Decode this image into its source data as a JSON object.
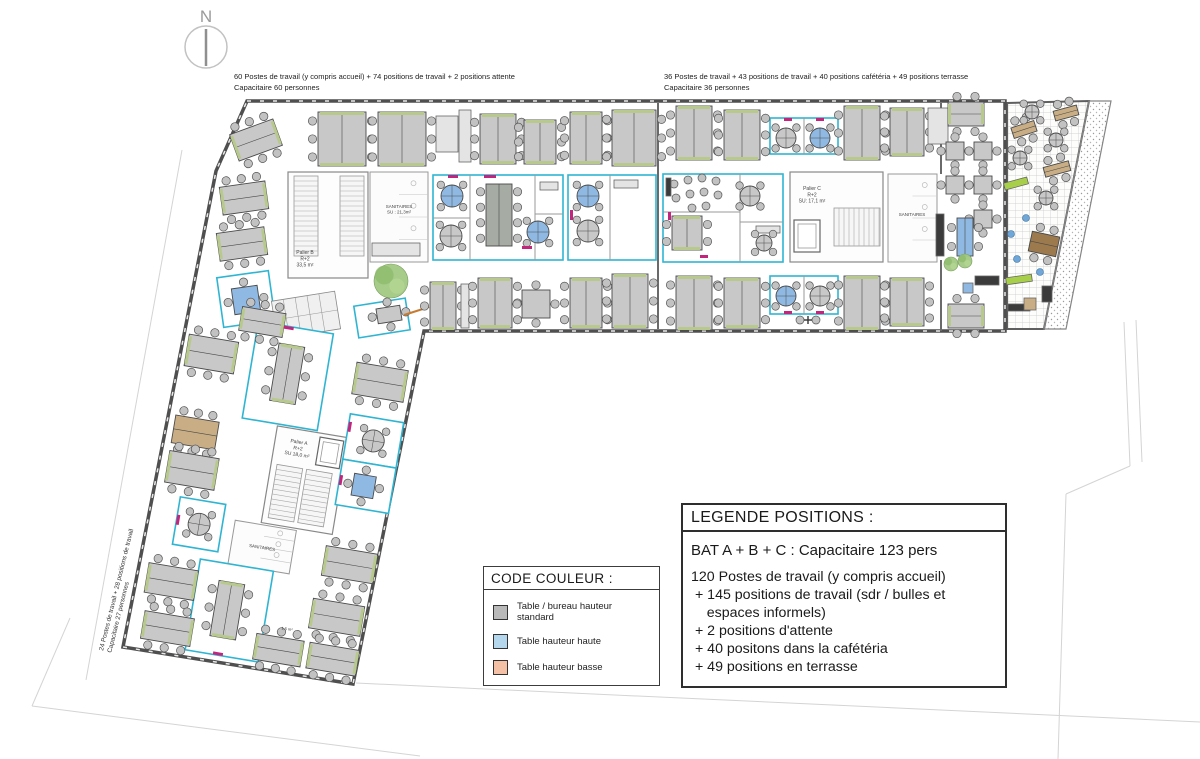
{
  "north": {
    "label": "N"
  },
  "annotations": {
    "bat_b": {
      "line1": "60 Postes de travail (y compris accueil) + 74 positions de travail + 2 positions attente",
      "line2": "Capacitaire 60 personnes"
    },
    "bat_c": {
      "line1": "36 Postes de travail + 43 positions de travail + 40 positions cafétéria + 49 positions terrasse",
      "line2": "Capacitaire 36 personnes"
    },
    "bat_a": {
      "line1": "24 Postes de travail + 28 positions de travail",
      "line2": "Capacitaire 27 personnes"
    }
  },
  "legend_color": {
    "title": "CODE COULEUR :",
    "items": [
      {
        "color": "#b9b9b9",
        "label": "Table / bureau hauteur standard"
      },
      {
        "color": "#b5d7ee",
        "label": "Table hauteur haute"
      },
      {
        "color": "#f4c1a6",
        "label": "Table hauteur basse"
      }
    ]
  },
  "legend_positions": {
    "title": "LEGENDE POSITIONS :",
    "subtitle": "BAT A + B + C : Capacitaire 123 pers",
    "lines": [
      "120 Postes de travail (y compris accueil)",
      " + 145 positions de travail (sdr / bulles et",
      "    espaces informels)",
      " + 2 positions d'attente",
      " + 40 positons dans la cafétéria",
      " + 49 positions en terrasse"
    ]
  },
  "colors": {
    "wall": "#4f4f4f",
    "room_accent": "#2fb5d2",
    "table_standard": "#c8c8c8",
    "table_high": "#8fb9e2",
    "table_low": "#f4c1a6",
    "table_dark": "#a6aba3",
    "table_tan": "#c9ae85",
    "table_brown": "#9c7a4e",
    "greenery": "#a3c983",
    "lime": "#a8cf4a",
    "magenta": "#c2267c",
    "chair": "#c2c2c2",
    "dark_furniture": "#3b3b3b",
    "blue_dot": "#6fa8d8"
  },
  "floorplan": {
    "outline": "247,101 1005,101 1005,331 424,331 353,684 123,647 216,171",
    "terrace": {
      "grid": "1007,103 1089,101 1044,329 1007,329",
      "gravel": "1089,101 1111,101 1066,329 1044,329",
      "items": [
        [
          "h",
          1012,
          124,
          24,
          11,
          -18,
          "tan"
        ],
        [
          "h",
          1054,
          108,
          24,
          10,
          -15,
          "tan"
        ],
        [
          "h",
          1044,
          164,
          26,
          10,
          -15,
          "tan"
        ],
        [
          "h",
          1030,
          234,
          28,
          20,
          12,
          "brown"
        ],
        [
          "box",
          1004,
          180,
          24,
          7,
          "lime",
          -15
        ],
        [
          "box",
          1006,
          276,
          26,
          7,
          "lime",
          -8
        ],
        [
          "cross",
          1032,
          112,
          7,
          0,
          "gray"
        ],
        [
          "cross",
          1020,
          158,
          7,
          0,
          "gray"
        ],
        [
          "cross",
          1056,
          140,
          7,
          0,
          "gray"
        ],
        [
          "cross",
          1046,
          198,
          7,
          0,
          "gray"
        ],
        [
          "dot",
          1026,
          218
        ],
        [
          "dot",
          1011,
          234
        ],
        [
          "dot",
          1017,
          259
        ],
        [
          "dot",
          1040,
          272
        ],
        [
          "box",
          1042,
          286,
          10,
          16,
          "dark"
        ],
        [
          "box",
          1008,
          304,
          22,
          7,
          "dark"
        ],
        [
          "box",
          1024,
          298,
          12,
          12,
          "tan"
        ]
      ]
    },
    "site_lines": [
      [
        182,
        150,
        86,
        680
      ],
      [
        70,
        618,
        32,
        706
      ],
      [
        32,
        706,
        420,
        756
      ],
      [
        356,
        683,
        1200,
        722
      ],
      [
        1124,
        322,
        1130,
        466
      ],
      [
        1136,
        320,
        1142,
        462
      ],
      [
        1130,
        466,
        1066,
        494
      ],
      [
        1066,
        494,
        1058,
        759
      ]
    ],
    "walls_inner": [
      [
        658,
        103,
        658,
        329
      ],
      [
        941,
        103,
        941,
        174
      ],
      [
        941,
        260,
        941,
        331
      ]
    ],
    "main": {
      "cores": [
        [
          288,
          172,
          80,
          106
        ],
        [
          790,
          172,
          93,
          90
        ]
      ],
      "stairs": [
        [
          294,
          176,
          24,
          80,
          "h"
        ],
        [
          340,
          176,
          24,
          80,
          "h"
        ],
        [
          834,
          208,
          46,
          38,
          "v"
        ],
        [
          612,
          214,
          40,
          44,
          "v"
        ]
      ],
      "elevators": [
        [
          794,
          220,
          26,
          32
        ]
      ],
      "sanitaires": [
        [
          370,
          172,
          58,
          90
        ],
        [
          888,
          174,
          49,
          88
        ]
      ],
      "rooms": [
        [
          433,
          175,
          130,
          85,
          0
        ],
        [
          568,
          175,
          88,
          85,
          0
        ],
        [
          770,
          118,
          68,
          36,
          0
        ],
        [
          770,
          276,
          68,
          38,
          0
        ],
        [
          663,
          174,
          120,
          88,
          0
        ],
        [
          220,
          274,
          52,
          50,
          -8
        ],
        [
          356,
          302,
          52,
          32,
          -9
        ]
      ],
      "partitions": [
        [
          470,
          175,
          470,
          260
        ],
        [
          535,
          175,
          535,
          260
        ],
        [
          433,
          218,
          470,
          218
        ],
        [
          535,
          214,
          563,
          214
        ],
        [
          610,
          175,
          610,
          260
        ],
        [
          804,
          118,
          804,
          154
        ],
        [
          804,
          276,
          804,
          314
        ],
        [
          740,
          174,
          740,
          262
        ],
        [
          663,
          212,
          740,
          212
        ],
        [
          740,
          222,
          783,
          222
        ]
      ],
      "items": [
        [
          "h",
          233,
          126,
          46,
          28,
          -20
        ],
        [
          "v",
          318,
          112,
          48,
          54,
          0
        ],
        [
          "v",
          378,
          112,
          48,
          54,
          0
        ],
        [
          "box",
          436,
          116,
          22,
          36
        ],
        [
          "box",
          459,
          110,
          12,
          52
        ],
        [
          "v",
          480,
          114,
          36,
          50,
          0
        ],
        [
          "v",
          524,
          120,
          32,
          44,
          0
        ],
        [
          "v",
          570,
          112,
          32,
          52,
          0
        ],
        [
          "v",
          612,
          110,
          44,
          56,
          0
        ],
        [
          "h",
          221,
          184,
          46,
          28,
          -8
        ],
        [
          "h",
          218,
          230,
          48,
          28,
          -8
        ],
        [
          "sq",
          233,
          287,
          26,
          26,
          -8,
          "blue"
        ],
        [
          "lockers",
          274,
          296,
          64,
          38,
          -9
        ],
        [
          "box",
          372,
          243,
          48,
          13
        ],
        [
          "plant",
          391,
          281,
          17
        ],
        [
          "sq",
          377,
          307,
          24,
          15,
          -9
        ],
        [
          "line",
          404,
          315,
          429,
          307
        ],
        [
          "v",
          430,
          282,
          26,
          48,
          0
        ],
        [
          "box",
          461,
          284,
          8,
          44
        ],
        [
          "v",
          478,
          278,
          34,
          50,
          0
        ],
        [
          "sq",
          522,
          290,
          28,
          28,
          0
        ],
        [
          "v",
          570,
          278,
          32,
          50,
          0
        ],
        [
          "v",
          612,
          274,
          36,
          54,
          0
        ],
        [
          "cross",
          452,
          196,
          11,
          0,
          "blue"
        ],
        [
          "cross",
          451,
          236,
          11,
          0,
          "gray"
        ],
        [
          "v",
          486,
          184,
          26,
          62,
          0,
          "dk"
        ],
        [
          "box",
          540,
          182,
          18,
          8
        ],
        [
          "cross",
          538,
          232,
          11,
          0,
          "blue"
        ],
        [
          "cross",
          588,
          196,
          11,
          0,
          "blue"
        ],
        [
          "cross",
          588,
          231,
          11,
          0,
          "gray"
        ],
        [
          "box",
          614,
          180,
          24,
          8
        ],
        [
          "chair",
          674,
          184
        ],
        [
          "chair",
          688,
          180
        ],
        [
          "chair",
          702,
          178
        ],
        [
          "chair",
          716,
          181
        ],
        [
          "chair",
          676,
          198
        ],
        [
          "chair",
          690,
          194
        ],
        [
          "chair",
          704,
          192
        ],
        [
          "chair",
          718,
          195
        ],
        [
          "chair",
          692,
          208
        ],
        [
          "chair",
          706,
          206
        ],
        [
          "box",
          666,
          178,
          5,
          18,
          "dark"
        ],
        [
          "v",
          672,
          216,
          30,
          34,
          0
        ],
        [
          "cross",
          750,
          196,
          10,
          0,
          "gray"
        ],
        [
          "box",
          756,
          226,
          24,
          7
        ],
        [
          "cross",
          764,
          243,
          8,
          0,
          "gray"
        ],
        [
          "v",
          676,
          106,
          36,
          54,
          0
        ],
        [
          "v",
          724,
          110,
          36,
          50,
          0
        ],
        [
          "cross",
          786,
          138,
          10,
          0,
          "gray"
        ],
        [
          "cross",
          820,
          138,
          10,
          0,
          "blue"
        ],
        [
          "v",
          844,
          106,
          36,
          54,
          0
        ],
        [
          "v",
          890,
          108,
          34,
          48,
          0
        ],
        [
          "box",
          928,
          108,
          20,
          36
        ],
        [
          "h",
          948,
          102,
          36,
          24,
          0
        ],
        [
          "v",
          676,
          276,
          36,
          54,
          0
        ],
        [
          "v",
          724,
          278,
          36,
          50,
          0
        ],
        [
          "cross",
          786,
          296,
          10,
          0,
          "blue"
        ],
        [
          "cross",
          820,
          296,
          10,
          0,
          "gray"
        ],
        [
          "chair",
          800,
          320
        ],
        [
          "chair",
          816,
          320
        ],
        [
          "plus",
          808,
          320
        ],
        [
          "v",
          844,
          276,
          36,
          54,
          0
        ],
        [
          "v",
          890,
          278,
          34,
          48,
          0
        ],
        [
          "h",
          948,
          304,
          36,
          24,
          0
        ],
        [
          "sq",
          946,
          142,
          18,
          18,
          0
        ],
        [
          "sq",
          974,
          142,
          18,
          18,
          0
        ],
        [
          "sq",
          946,
          176,
          18,
          18,
          0
        ],
        [
          "sq",
          974,
          176,
          18,
          18,
          0
        ],
        [
          "sq",
          974,
          210,
          18,
          18,
          0
        ],
        [
          "v",
          957,
          218,
          16,
          38,
          0,
          "blue"
        ],
        [
          "box",
          936,
          214,
          8,
          42,
          "dark"
        ],
        [
          "box",
          975,
          276,
          24,
          9,
          "dark"
        ],
        [
          "plant",
          951,
          264,
          7
        ],
        [
          "plant",
          965,
          261,
          7
        ],
        [
          "box",
          963,
          283,
          10,
          10,
          "blueicon"
        ]
      ],
      "accents": [
        [
          448,
          175,
          10,
          3
        ],
        [
          484,
          175,
          12,
          3
        ],
        [
          522,
          246,
          10,
          3
        ],
        [
          570,
          210,
          3,
          10
        ],
        [
          784,
          118,
          8,
          3
        ],
        [
          816,
          118,
          8,
          3
        ],
        [
          784,
          311,
          8,
          3
        ],
        [
          816,
          311,
          8,
          3
        ],
        [
          668,
          212,
          3,
          8
        ],
        [
          700,
          255,
          8,
          3
        ]
      ],
      "labels": [
        {
          "t": [
            "Palier B",
            "R+2",
            "33,5 m²"
          ],
          "x": 305,
          "y": 254,
          "s": 5
        },
        {
          "t": [
            "SANITAIRES",
            "SU : 21,3m²"
          ],
          "x": 399,
          "y": 208,
          "s": 4.5
        },
        {
          "t": [
            "Palier C",
            "R+2",
            "SU: 17,1 m²"
          ],
          "x": 812,
          "y": 190,
          "s": 5
        },
        {
          "t": [
            "SANITAIRES"
          ],
          "x": 912,
          "y": 216,
          "s": 4.5
        }
      ]
    },
    "wing": {
      "rotate": [
        9.5,
        192,
        294
      ],
      "cores": [
        [
          298,
          410,
          72,
          98
        ]
      ],
      "stairs": [
        [
          304,
          448,
          26,
          54,
          "h"
        ],
        [
          334,
          448,
          26,
          54,
          "h"
        ]
      ],
      "elevators": [
        [
          342,
          414,
          24,
          28
        ]
      ],
      "sanitaires": [
        [
          272,
          510,
          62,
          44
        ]
      ],
      "rooms": [
        [
          262,
          310,
          76,
          98
        ],
        [
          244,
          554,
          74,
          92
        ],
        [
          368,
          386,
          54,
          46
        ],
        [
          368,
          432,
          54,
          46
        ],
        [
          214,
          496,
          46,
          48
        ]
      ],
      "partitions": [],
      "items": [
        [
          "h",
          244,
          298,
          44,
          24,
          0
        ],
        [
          "h",
          196,
          334,
          50,
          32,
          0
        ],
        [
          "h",
          196,
          416,
          44,
          28,
          0,
          "tan"
        ],
        [
          "h",
          196,
          452,
          50,
          32,
          0
        ],
        [
          "h",
          194,
          566,
          50,
          30,
          0
        ],
        [
          "h",
          198,
          614,
          50,
          28,
          0
        ],
        [
          "h",
          366,
          334,
          52,
          32,
          0
        ],
        [
          "cross",
          395,
          409,
          11,
          0,
          "gray"
        ],
        [
          "sq",
          382,
          444,
          22,
          22,
          0,
          "blue"
        ],
        [
          "h",
          366,
          520,
          52,
          30,
          0
        ],
        [
          "h",
          362,
          574,
          52,
          30,
          0
        ],
        [
          "h",
          366,
          618,
          50,
          26,
          0
        ],
        [
          "h",
          312,
          618,
          48,
          26,
          0
        ],
        [
          "v",
          286,
          328,
          26,
          58,
          0
        ],
        [
          "v",
          266,
          572,
          26,
          56,
          0
        ],
        [
          "cross",
          237,
          520,
          11,
          0,
          "gray"
        ]
      ],
      "accents": [
        [
          288,
          310,
          10,
          3
        ],
        [
          272,
          643,
          10,
          3
        ],
        [
          368,
          448,
          3,
          10
        ],
        [
          214,
          514,
          3,
          10
        ],
        [
          368,
          394,
          3,
          10
        ]
      ],
      "labels": [
        {
          "t": [
            "Palier A",
            "R+2",
            "SU 18,0 m²"
          ],
          "x": 322,
          "y": 424,
          "s": 5
        },
        {
          "t": [
            "SANITAIRES"
          ],
          "x": 303,
          "y": 534,
          "s": 4.5
        },
        {
          "t": [
            "1,5 m²"
          ],
          "x": 341,
          "y": 610,
          "s": 4
        }
      ]
    }
  }
}
